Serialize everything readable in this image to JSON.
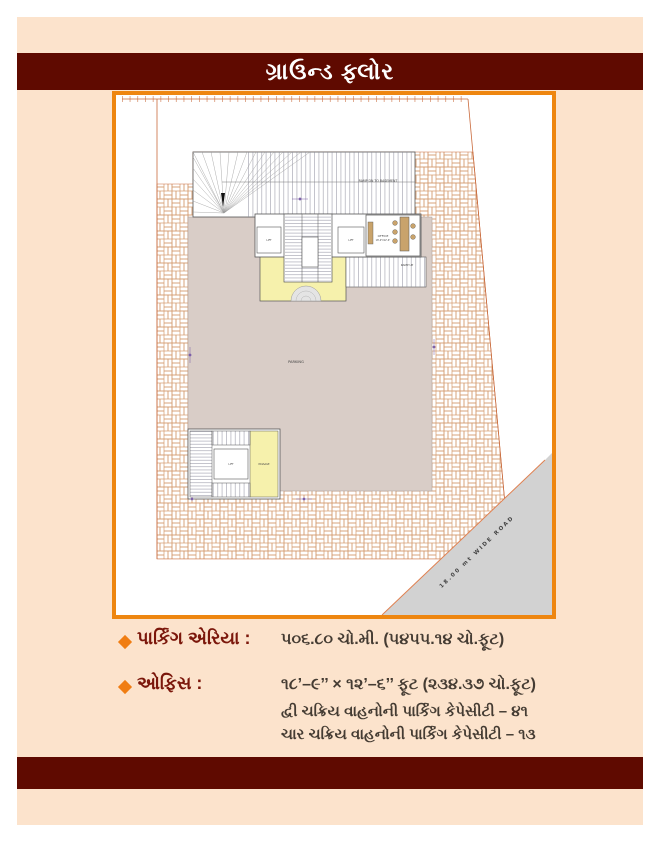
{
  "page": {
    "title": "ગ્રાઉન્ડ ફ્લોર",
    "colors": {
      "background": "#FFFFFF",
      "panel": "#FCE3CC",
      "maroon_bar": "#5F0A00",
      "title_text": "#FFFFFF",
      "plan_frame": "#EE8610"
    }
  },
  "plan": {
    "labels": {
      "ramp_dn": "RAMP DN TO BASEMENT",
      "ramp_up": "RAMP UP",
      "lift_left": "LIFT",
      "lift_right": "LIFT",
      "office": "OFFICE",
      "office_dim": "18'-9\"X12'-6\"",
      "foyer": "FOYER",
      "parking": "PARKING",
      "lift_bottom": "LIFT",
      "passage": "PASSAGE",
      "road": "18.00 mt WIDE ROAD"
    },
    "colors": {
      "parking_fill": "#D9CDC7",
      "foyer_fill": "#F6F1AC",
      "road_fill": "#D2D2D2",
      "brick_line": "#D49A6E",
      "boundary_line": "#C96A3C",
      "drawing_line": "#555555",
      "dimension_purple": "#7B5EA7",
      "furniture_tan": "#C9A36B",
      "road_text": "#2E2E55"
    }
  },
  "details": {
    "bullet_color": "#F07D12",
    "rows": [
      {
        "label": "પાર્કિંગ એરિયા :",
        "value": "૫૦૬.૮૦ ચો.મી. (૫૪૫૫.૧૪ ચો.ફૂટ)"
      },
      {
        "label": "ઓફિસ :",
        "value": "૧૮’–૯’’ × ૧૨’–૬’’ ફૂટ (૨૩૪.૩૭ ચો.ફૂટ)"
      }
    ],
    "notes": [
      "દ્વી ચક્રિય વાહનોની પાર્કિંગ કેપેસીટી – ૪૧",
      "ચાર ચક્રિય વાહનોની પાર્કિંગ કેપેસીટી – ૧૩"
    ]
  }
}
